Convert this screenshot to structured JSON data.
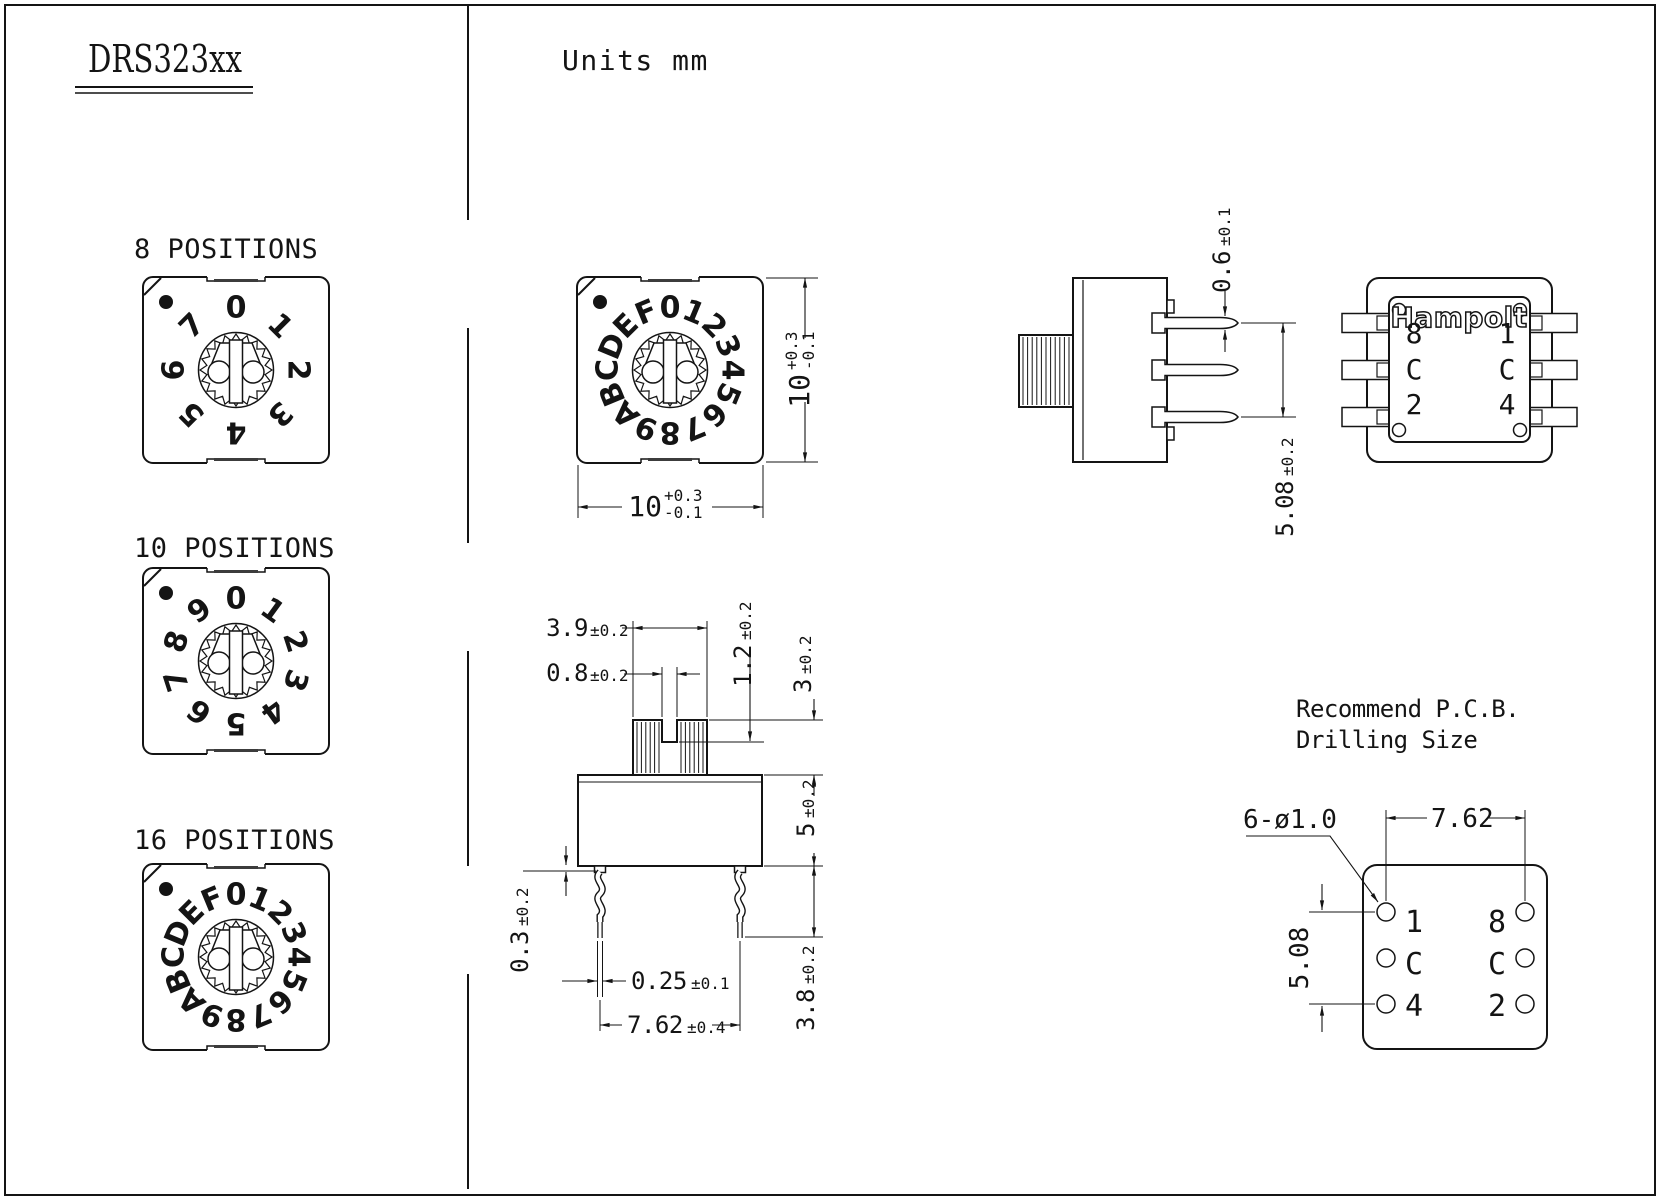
{
  "title": "DRS323xx",
  "units_label": "Units mm",
  "colors": {
    "line": "#141414",
    "background": "#ffffff"
  },
  "dials": [
    {
      "label": "8 POSITIONS",
      "positions": [
        "0",
        "1",
        "2",
        "3",
        "4",
        "5",
        "6",
        "7"
      ]
    },
    {
      "label": "10 POSITIONS",
      "positions": [
        "0",
        "1",
        "2",
        "3",
        "4",
        "5",
        "6",
        "7",
        "8",
        "9"
      ]
    },
    {
      "label": "16 POSITIONS",
      "positions": [
        "0",
        "1",
        "2",
        "3",
        "4",
        "5",
        "6",
        "7",
        "8",
        "9",
        "A",
        "B",
        "C",
        "D",
        "E",
        "F"
      ]
    }
  ],
  "top_view": {
    "width_dim": {
      "value": "10",
      "tol_plus": "+0.3",
      "tol_minus": "-0.1"
    },
    "height_dim": {
      "value": "10",
      "tol_plus": "+0.3",
      "tol_minus": "-0.1"
    }
  },
  "side_view": {
    "pin_thickness_dim": {
      "value": "0.6",
      "tol": "±0.1"
    },
    "pin_pitch_dim": {
      "value": "5.08",
      "tol": "±0.2"
    }
  },
  "back_view": {
    "brand": "Hampolt",
    "pin_labels_left": [
      "8",
      "C",
      "2"
    ],
    "pin_labels_right": [
      "1",
      "C",
      "4"
    ]
  },
  "front_view": {
    "knob_width_dim": {
      "value": "3.9",
      "tol": "±0.2"
    },
    "slot_width_dim": {
      "value": "0.8",
      "tol": "±0.2"
    },
    "slot_depth_dim": {
      "value": "1.2",
      "tol": "±0.2"
    },
    "knob_height_dim": {
      "value": "3",
      "tol": "±0.2"
    },
    "body_height_dim": {
      "value": "5",
      "tol": "±0.2"
    },
    "standoff_dim": {
      "value": "0.3",
      "tol": "±0.2"
    },
    "pin_width_dim": {
      "value": "0.25",
      "tol": "±0.1"
    },
    "pin_pitch_dim": {
      "value": "7.62",
      "tol": "±0.4"
    },
    "pin_length_dim": {
      "value": "3.8",
      "tol": "±0.2"
    }
  },
  "pcb": {
    "title_line1": "Recommend P.C.B.",
    "title_line2": "Drilling Size",
    "hole_callout": "6-ø1.0",
    "h_pitch": "7.62",
    "v_pitch": "5.08",
    "hole_labels_left": [
      "1",
      "C",
      "4"
    ],
    "hole_labels_right": [
      "8",
      "C",
      "2"
    ]
  }
}
